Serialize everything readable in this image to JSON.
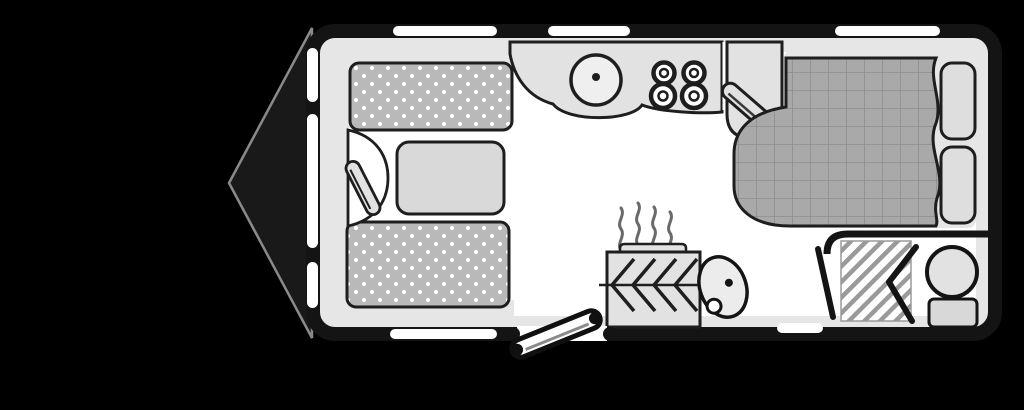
{
  "figure": {
    "type": "floorplan",
    "subject": "Top-down touring caravan floor plan, hitch nose on the left, rear washroom on the right",
    "colors": {
      "background": "#000000",
      "wall": "#141414",
      "lining": "#e6e6e6",
      "floor": "#ffffff",
      "outline": "#1e1e1e",
      "upholstery": "#b9b9b9",
      "upholstery_dot": "#ffffff",
      "furniture": "#e2e2e2",
      "table": "#d9d9d9",
      "bedding": "#a9a9a9",
      "bedding_grid": "#8e8e8e",
      "pillow": "#dedede",
      "hatch_stripe": "#9a9a9a",
      "heat_wave": "#6a6a6a",
      "nose_fill": "#191919",
      "nose_edge": "#8a8a8a",
      "window": "#ffffff",
      "door_leaf": "#ffffff"
    },
    "areas": [
      {
        "id": "lounge",
        "label": "Front lounge with two facing sofas and table"
      },
      {
        "id": "kitchen",
        "label": "Kitchen with sink and four-burner hob"
      },
      {
        "id": "bedroom",
        "label": "Fixed double bed with pillows"
      },
      {
        "id": "washroom",
        "label": "Rear corner washroom with shower and toilet"
      }
    ],
    "items": [
      {
        "id": "hitch-nose",
        "label": "A-frame hitch nose"
      },
      {
        "id": "body-shell",
        "label": "Caravan body shell wall"
      },
      {
        "id": "interior-floor",
        "label": "Interior floor"
      },
      {
        "id": "offside-sofa",
        "label": "Offside front sofa (dotted upholstery)"
      },
      {
        "id": "nearside-sofa",
        "label": "Nearside front sofa (dotted upholstery)"
      },
      {
        "id": "lounge-table",
        "label": "Lounge table"
      },
      {
        "id": "front-chest",
        "label": "Front chest with curved front"
      },
      {
        "id": "stowed-table",
        "label": "Stowed occasional table"
      },
      {
        "id": "kitchen-worktop",
        "label": "Kitchen worktop with curved front edge"
      },
      {
        "id": "sink",
        "label": "Round kitchen sink"
      },
      {
        "id": "hob",
        "label": "Four-burner hob"
      },
      {
        "id": "wardrobe",
        "label": "Wardrobe unit"
      },
      {
        "id": "wardrobe-door",
        "label": "Wardrobe door shown ajar"
      },
      {
        "id": "double-bed",
        "label": "Fixed double bed with grid-pattern duvet"
      },
      {
        "id": "pillows",
        "label": "Two pillows at bed head"
      },
      {
        "id": "space-heater",
        "label": "Space heater with finned element"
      },
      {
        "id": "heat-waves",
        "label": "Heat wave squiggles above heater"
      },
      {
        "id": "washbasin",
        "label": "Oval washbasin"
      },
      {
        "id": "washroom-partition",
        "label": "Washroom partition wall"
      },
      {
        "id": "shower",
        "label": "Shower tray with diagonal hatching"
      },
      {
        "id": "washroom-door",
        "label": "Washroom bi-fold door"
      },
      {
        "id": "toilet",
        "label": "Toilet with cistern base"
      },
      {
        "id": "entrance-door",
        "label": "Entrance door shown swung open"
      },
      {
        "id": "windows",
        "label": "Window openings in walls"
      }
    ]
  }
}
